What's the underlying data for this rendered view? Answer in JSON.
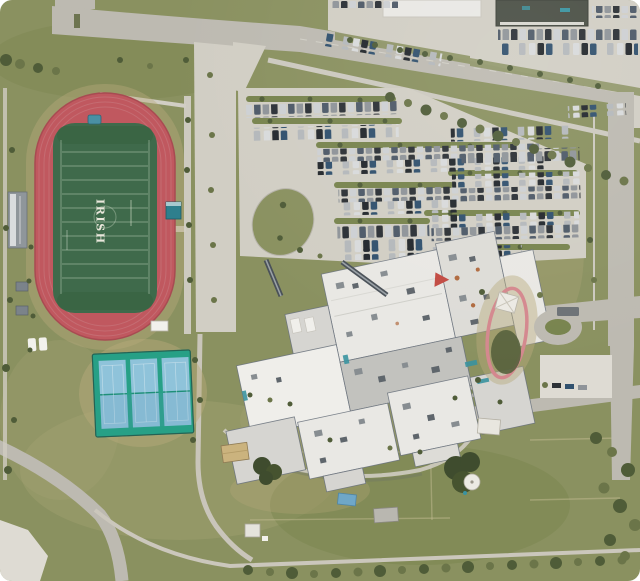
{
  "scene": {
    "type": "satellite-aerial-view",
    "field_text": "IRISH"
  },
  "colors": {
    "grass": "#8a9160",
    "grass_dark": "#78844e",
    "grass_worn": "#a6a273",
    "dirt": "#b9aa7c",
    "concrete": "#d1cec4",
    "concrete_light": "#dedbd3",
    "road": "#bdbab1",
    "track_red": "#c0585f",
    "track_dark": "#a84b52",
    "field_green": "#3f6a4b",
    "field_line": "#d9e4d2",
    "tennis_deck": "#27a086",
    "tennis_court": "#8fc3da",
    "roof_white": "#e9e8e4",
    "roof_gray": "#d6d5d1",
    "roof_shadow": "#c2c2be",
    "roof_edge": "#67707a",
    "dark_roof": "#4a4f45",
    "tree": "#4f5c38",
    "tree_light": "#6b7549",
    "teal": "#3a93a0",
    "rust": "#b06a3f",
    "white": "#f2f1ec"
  },
  "features": [
    "running-track",
    "football-field",
    "tennis-courts",
    "school-building",
    "main-parking-lot",
    "commercial-buildings",
    "practice-fields",
    "playground",
    "perimeter-roads",
    "tree-lines"
  ]
}
